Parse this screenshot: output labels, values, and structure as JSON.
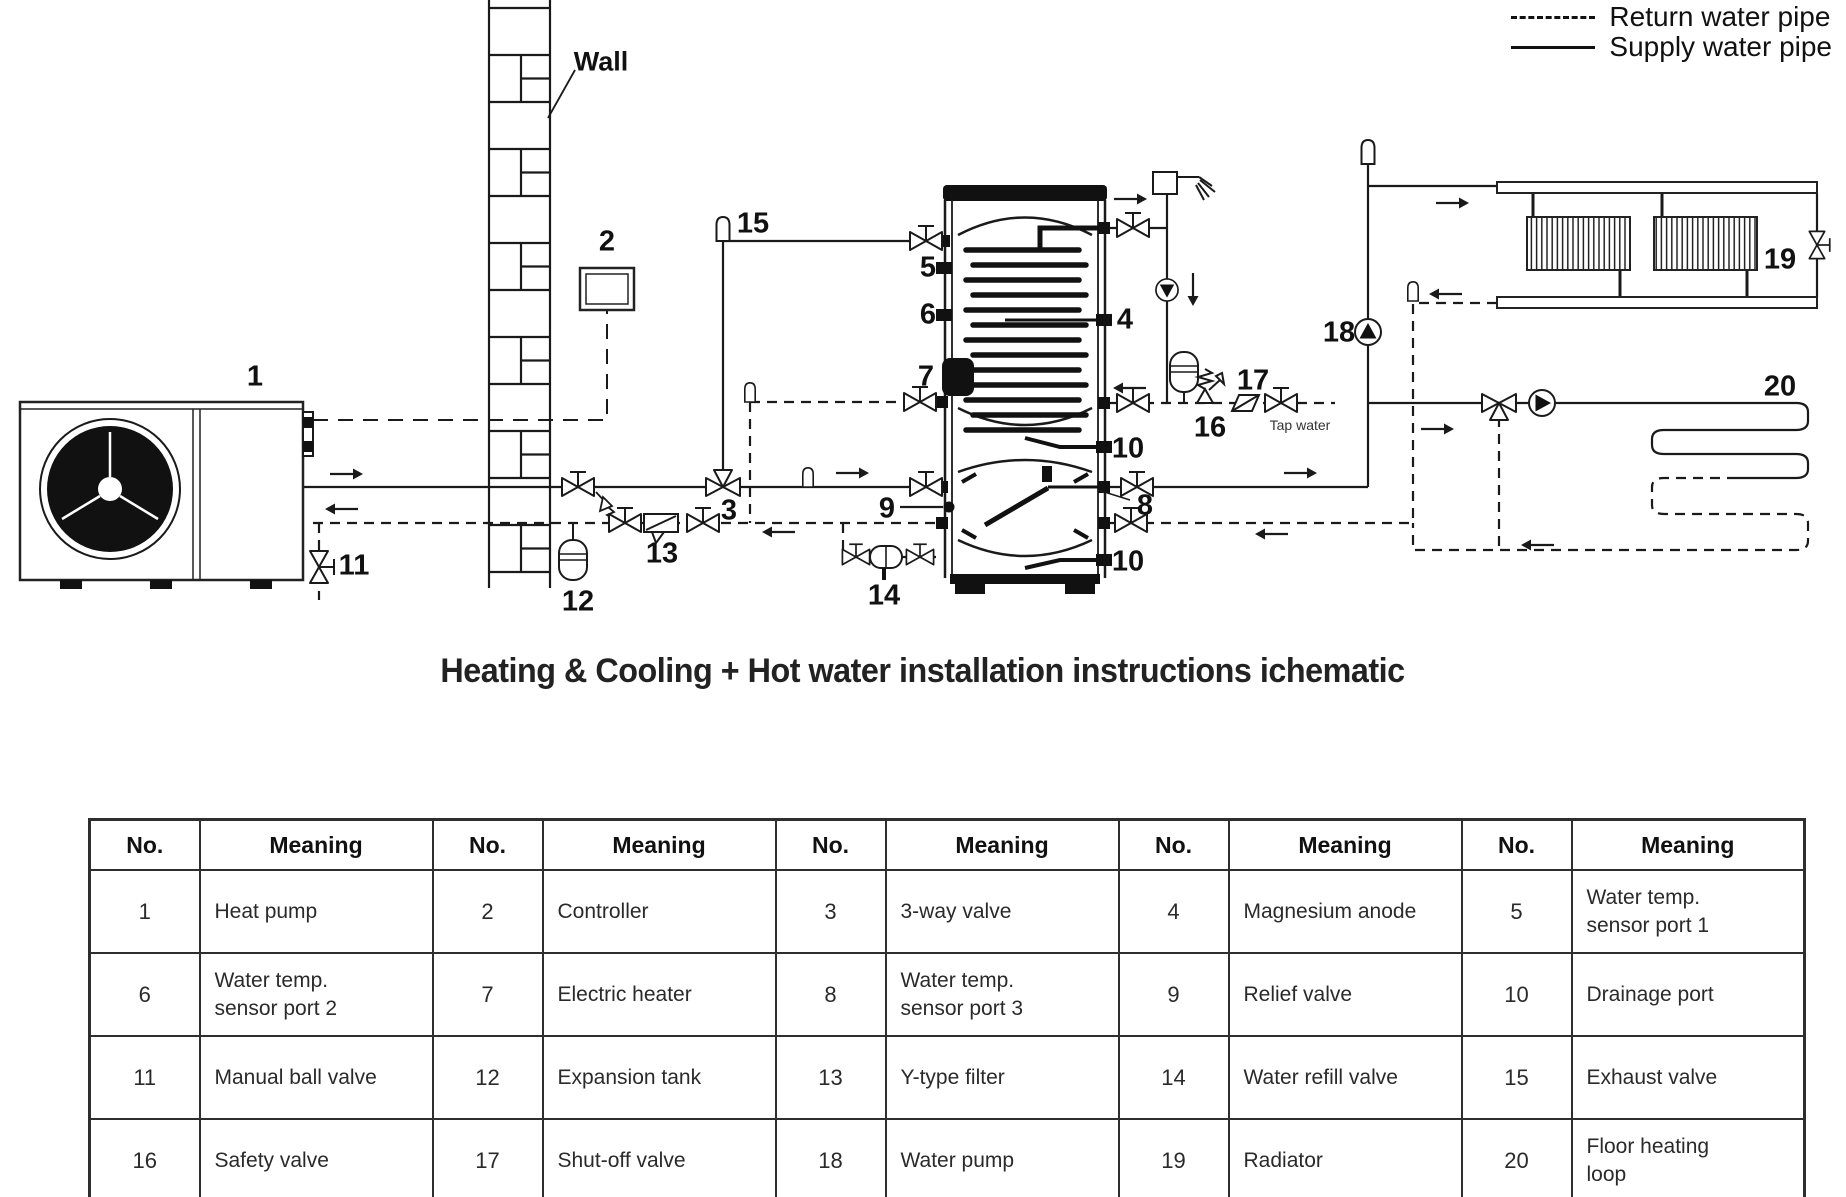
{
  "legend": {
    "items": [
      {
        "style": "dashed",
        "label": "Return water pipe"
      },
      {
        "style": "solid",
        "label": "Supply water pipe"
      }
    ]
  },
  "title": "Heating & Cooling + Hot water installation instructions ichematic",
  "diagram": {
    "labels": [
      {
        "text": "1",
        "x": 255,
        "y": 377
      },
      {
        "text": "Wall",
        "x": 601,
        "y": 62,
        "size": "wall"
      },
      {
        "text": "2",
        "x": 607,
        "y": 242
      },
      {
        "text": "15",
        "x": 753,
        "y": 224
      },
      {
        "text": "5",
        "x": 928,
        "y": 268
      },
      {
        "text": "6",
        "x": 928,
        "y": 315
      },
      {
        "text": "7",
        "x": 926,
        "y": 377
      },
      {
        "text": "4",
        "x": 1125,
        "y": 320
      },
      {
        "text": "3",
        "x": 729,
        "y": 511
      },
      {
        "text": "13",
        "x": 662,
        "y": 554
      },
      {
        "text": "12",
        "x": 578,
        "y": 602
      },
      {
        "text": "11",
        "x": 354,
        "y": 566
      },
      {
        "text": "14",
        "x": 884,
        "y": 596
      },
      {
        "text": "9",
        "x": 887,
        "y": 509
      },
      {
        "text": "8",
        "x": 1145,
        "y": 506
      },
      {
        "text": "10",
        "x": 1128,
        "y": 449
      },
      {
        "text": "10",
        "x": 1128,
        "y": 562
      },
      {
        "text": "16",
        "x": 1210,
        "y": 428
      },
      {
        "text": "17",
        "x": 1253,
        "y": 381
      },
      {
        "text": "18",
        "x": 1339,
        "y": 333
      },
      {
        "text": "19",
        "x": 1780,
        "y": 260
      },
      {
        "text": "20",
        "x": 1780,
        "y": 387
      },
      {
        "text": "Tap water",
        "x": 1300,
        "y": 425,
        "size": "small"
      }
    ]
  },
  "table": {
    "header_no": "No.",
    "header_meaning": "Meaning",
    "entries": [
      {
        "no": "1",
        "meaning": "Heat pump"
      },
      {
        "no": "2",
        "meaning": "Controller"
      },
      {
        "no": "3",
        "meaning": "3-way valve"
      },
      {
        "no": "4",
        "meaning": "Magnesium anode"
      },
      {
        "no": "5",
        "meaning": "Water temp.\nsensor port 1"
      },
      {
        "no": "6",
        "meaning": "Water temp.\nsensor port 2"
      },
      {
        "no": "7",
        "meaning": "Electric heater"
      },
      {
        "no": "8",
        "meaning": "Water temp.\nsensor port 3"
      },
      {
        "no": "9",
        "meaning": "Relief valve"
      },
      {
        "no": "10",
        "meaning": "Drainage port"
      },
      {
        "no": "11",
        "meaning": "Manual ball valve"
      },
      {
        "no": "12",
        "meaning": "Expansion tank"
      },
      {
        "no": "13",
        "meaning": "Y-type filter"
      },
      {
        "no": "14",
        "meaning": "Water refill valve"
      },
      {
        "no": "15",
        "meaning": "Exhaust valve"
      },
      {
        "no": "16",
        "meaning": "Safety valve"
      },
      {
        "no": "17",
        "meaning": "Shut-off valve"
      },
      {
        "no": "18",
        "meaning": "Water pump"
      },
      {
        "no": "19",
        "meaning": "Radiator"
      },
      {
        "no": "20",
        "meaning": "Floor heating\nloop"
      }
    ]
  }
}
